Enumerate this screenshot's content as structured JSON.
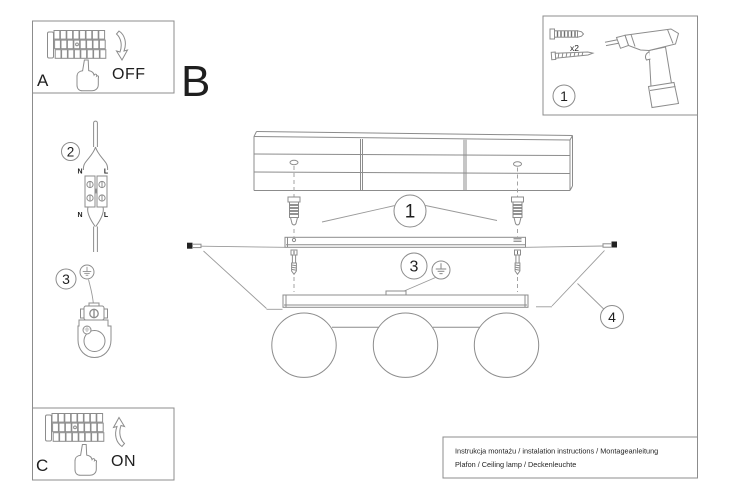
{
  "panel_a": {
    "label": "A",
    "state": "OFF"
  },
  "panel_b": {
    "label": "B"
  },
  "panel_c": {
    "label": "C",
    "state": "ON"
  },
  "step2": {
    "number": "2",
    "labels": {
      "top_left": "N",
      "top_right": "L",
      "bottom_left": "N",
      "bottom_right": "L"
    }
  },
  "step3": {
    "number": "3"
  },
  "hardware": {
    "step": "1",
    "anchor_qty": "x2"
  },
  "callouts": {
    "anchors": "1",
    "ground": "3",
    "side_screws": "4"
  },
  "footer": {
    "line1": "Instrukcja montażu / instalation instructions / Montageanleitung",
    "line2": "Plafon / Ceiling lamp / Deckenleuchte"
  },
  "colors": {
    "line": "#8c8c8c",
    "text": "#1f1f1f",
    "background": "#ffffff"
  }
}
